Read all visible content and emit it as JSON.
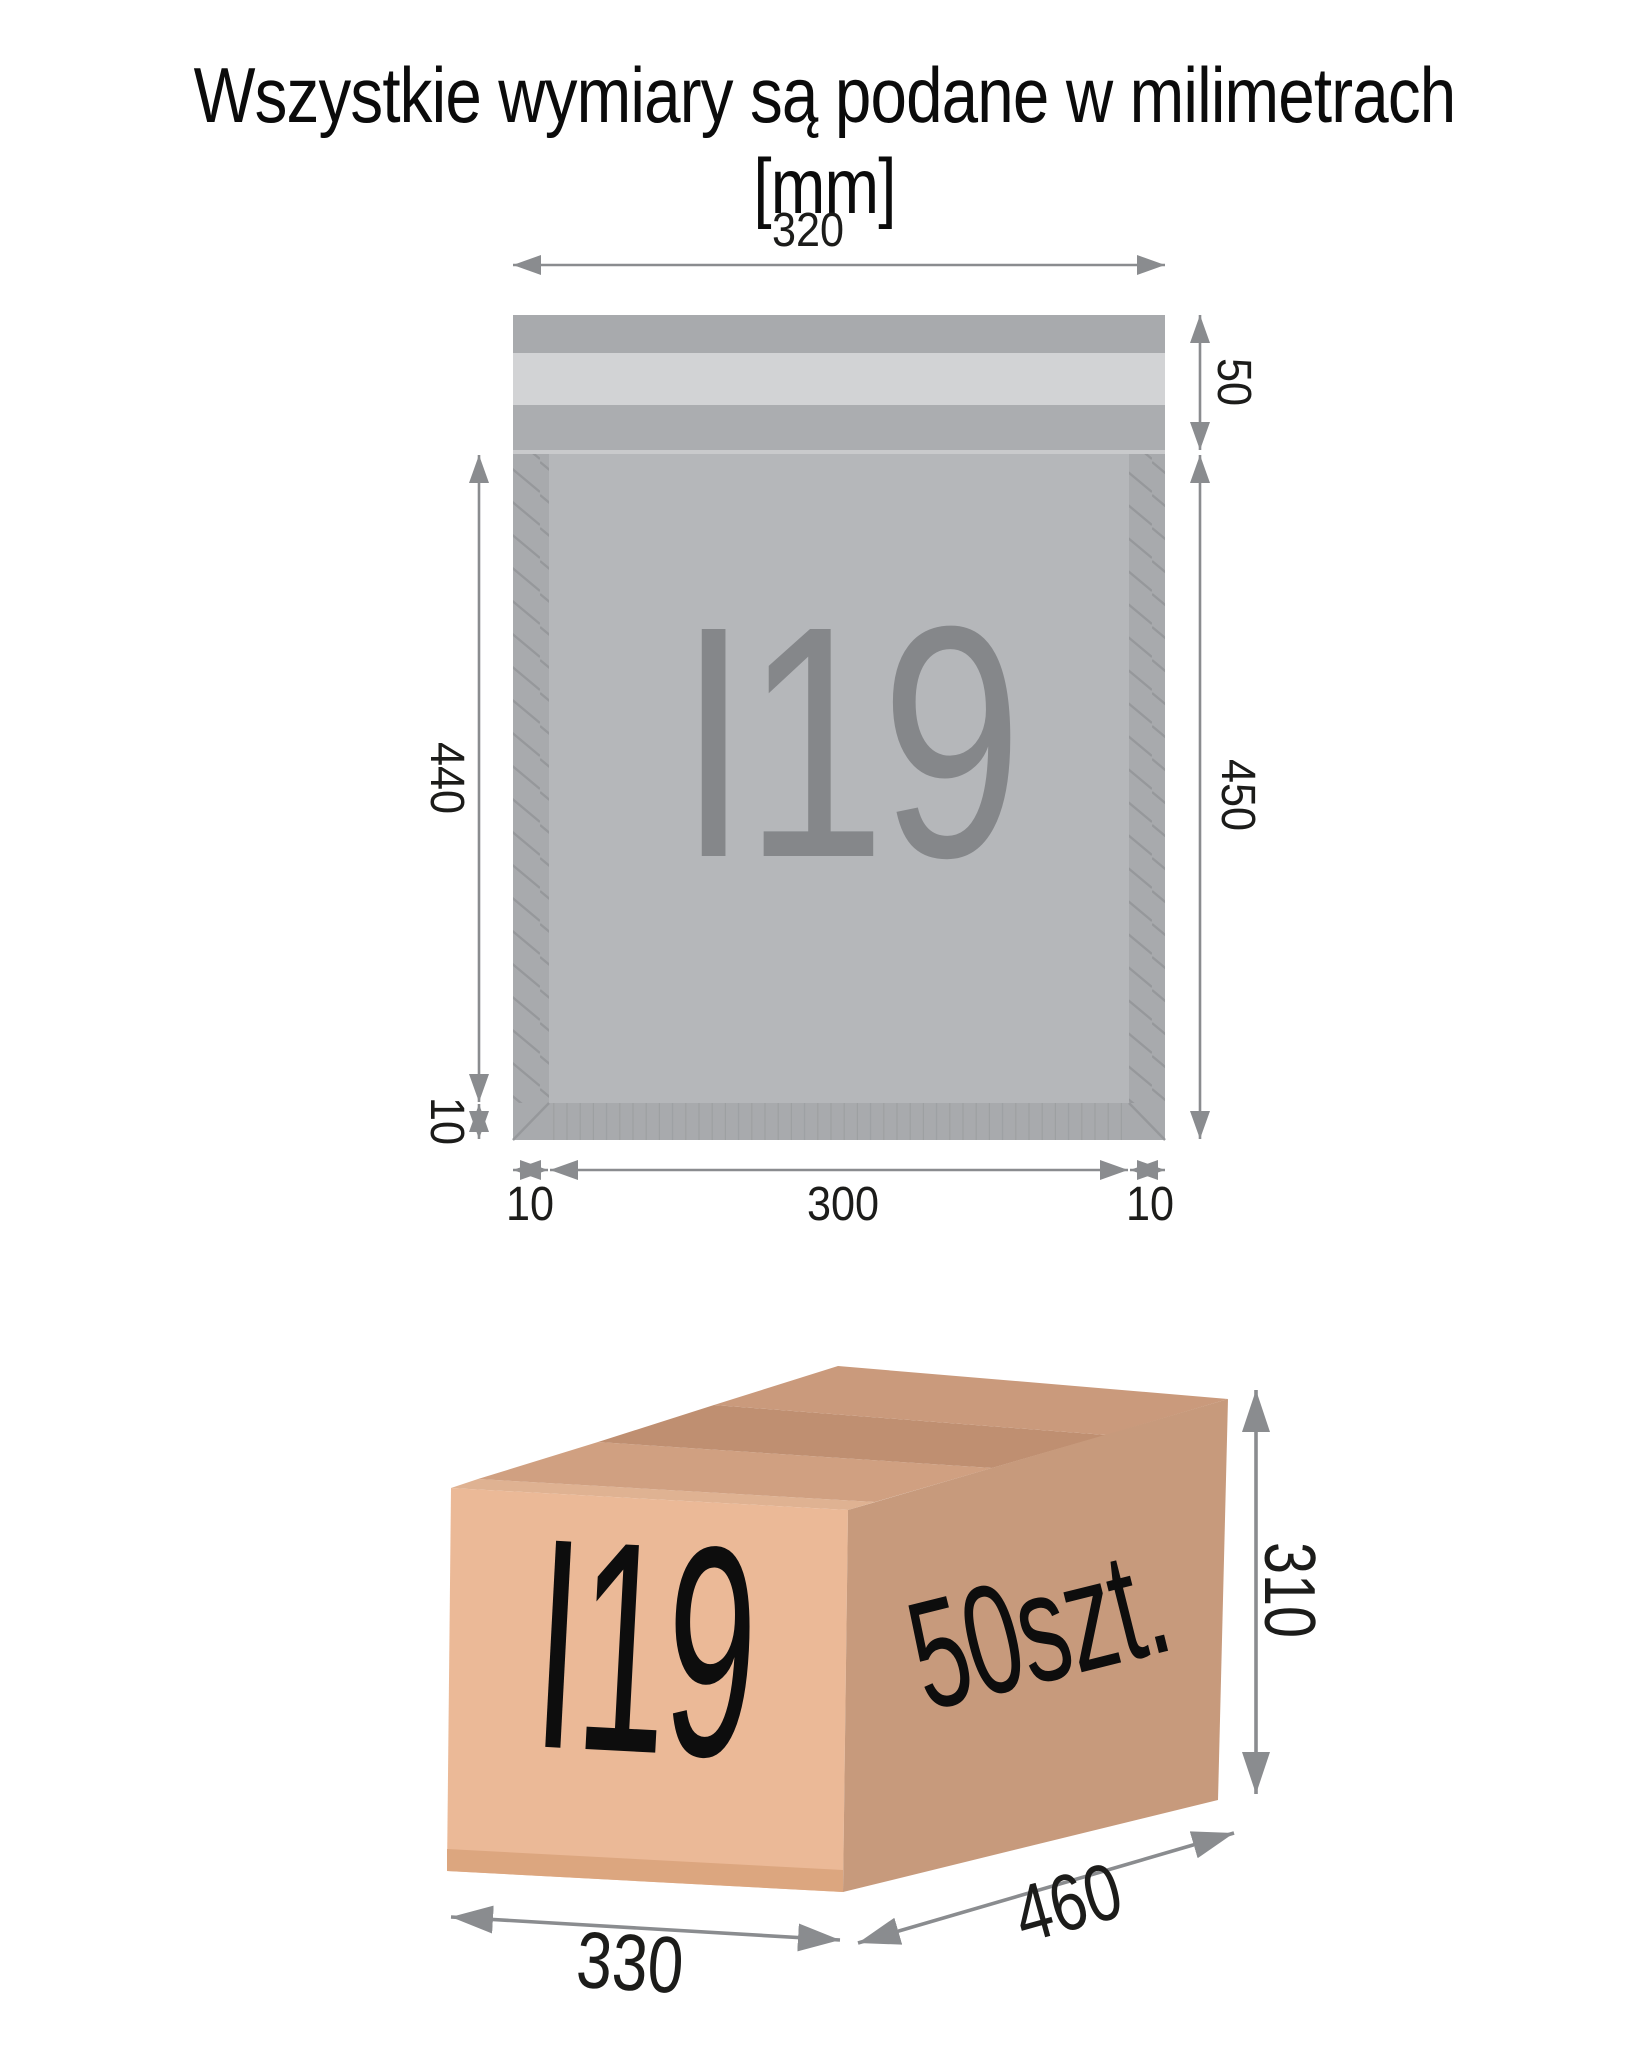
{
  "title": "Wszystkie wymiary są podane w milimetrach [mm]",
  "envelope": {
    "label": "I19",
    "dims": {
      "width": "320",
      "flap_height": "50",
      "inner_height": "440",
      "bottom_border": "10",
      "total_height": "450",
      "left_border": "10",
      "inner_width": "300",
      "right_border": "10"
    },
    "colors": {
      "band": "#a8aaad",
      "adhesive_strip": "#d2d3d5",
      "body": "#a8aaad",
      "inner": "#b5b7ba",
      "hatch_line": "#96989b",
      "label_text": "#85878a"
    }
  },
  "box": {
    "label": "I19",
    "quantity": "50szt.",
    "dims": {
      "height": "310",
      "width": "330",
      "depth": "460"
    },
    "colors": {
      "front_face": "#ebb997",
      "side_face": "#c79a7c",
      "top_face": "#ca9a7c",
      "top_seam": "#bf8f71"
    }
  },
  "dimension_line_color": "#8a8c8f",
  "dimension_text_color": "#1c1c1a"
}
